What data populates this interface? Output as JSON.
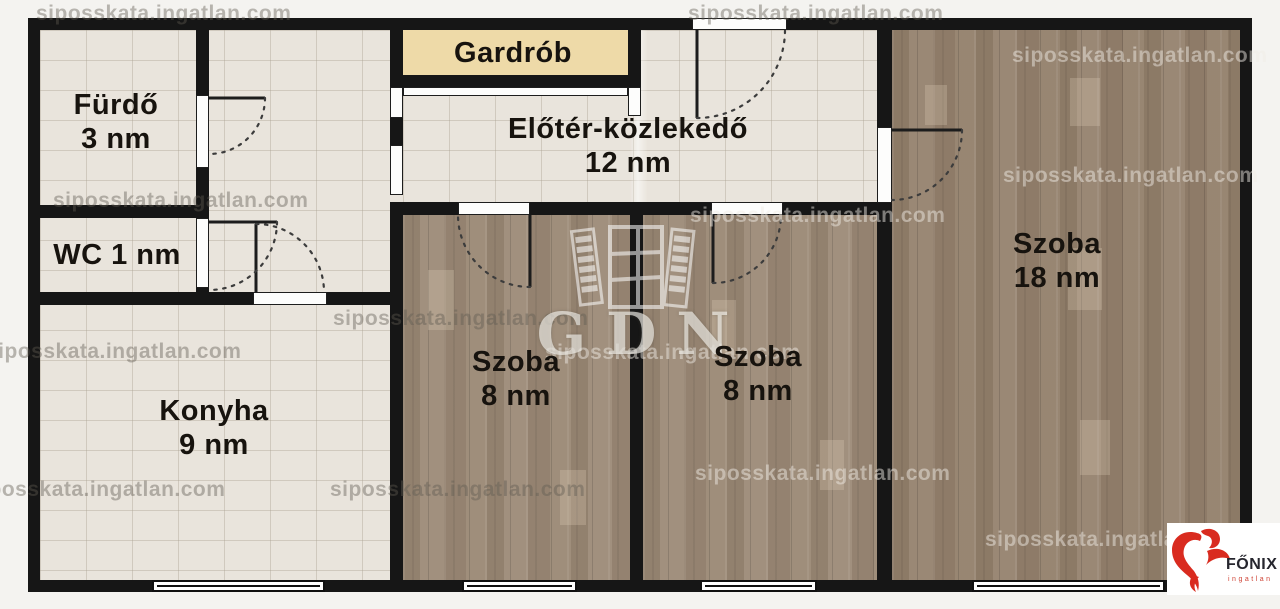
{
  "plan": {
    "rooms": [
      {
        "name": "Fürdő",
        "area": "3 nm"
      },
      {
        "name": "WC 1 nm",
        "area": ""
      },
      {
        "name": "Konyha",
        "area": "9 nm"
      },
      {
        "name": "Gardrób",
        "area": ""
      },
      {
        "name": "Előtér-közlekedő",
        "area": "12 nm"
      },
      {
        "name": "Szoba",
        "area": "8 nm"
      },
      {
        "name": "Szoba",
        "area": "8 nm"
      },
      {
        "name": "Szoba",
        "area": "18 nm"
      }
    ]
  },
  "watermark": {
    "text": "siposskata.ingatlan.com",
    "gdn_text": "GDN"
  },
  "logo": {
    "brand": "FŐNIX",
    "sub": "ingatlan"
  },
  "colors": {
    "wall": "#161616",
    "tile": "#e9e4dc",
    "wood": "#9c8a77",
    "wood_dark": "#95826e",
    "closet_fill": "#eedaa8",
    "logo_red": "#d92b1f",
    "label": "#17130e"
  }
}
